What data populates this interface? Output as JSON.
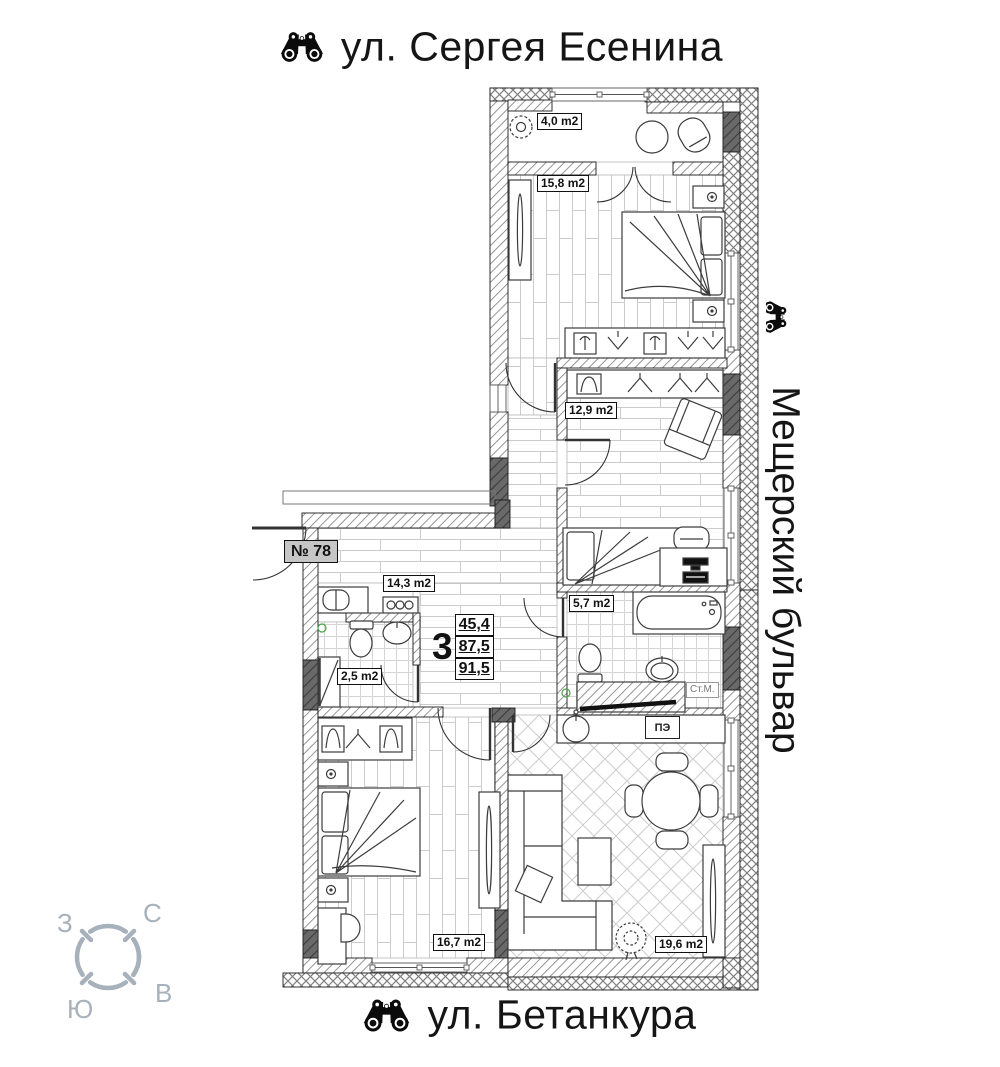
{
  "streets": {
    "top": "ул. Сергея Есенина",
    "right": "Мещерский бульвар",
    "bottom": "ул. Бетанкура"
  },
  "apartment": {
    "number": "№ 78",
    "rooms_count": "3",
    "living_area": "45,4",
    "floor_area": "87,5",
    "total_area": "91,5"
  },
  "rooms": {
    "balcony": {
      "label": "4,0 m2"
    },
    "bedroom_master": {
      "label": "15,8 m2"
    },
    "bedroom_kids": {
      "label": "12,9 m2"
    },
    "hallway": {
      "label": "14,3 m2"
    },
    "wc": {
      "label": "2,5 m2"
    },
    "bathroom": {
      "label": "5,7 m2"
    },
    "bedroom_second": {
      "label": "16,7 m2"
    },
    "living_kitchen": {
      "label": "19,6 m2"
    }
  },
  "equipment": {
    "washing_machine": "Ст.М.",
    "electric_stove": "ПЭ"
  },
  "compass": {
    "north": "С",
    "south": "Ю",
    "west": "З",
    "east": "В"
  },
  "colors": {
    "ink": "#1a1a1a",
    "compass": "#a7b1bb",
    "label_bg": "#c6c6c6",
    "accent_green": "#4aa44a"
  }
}
